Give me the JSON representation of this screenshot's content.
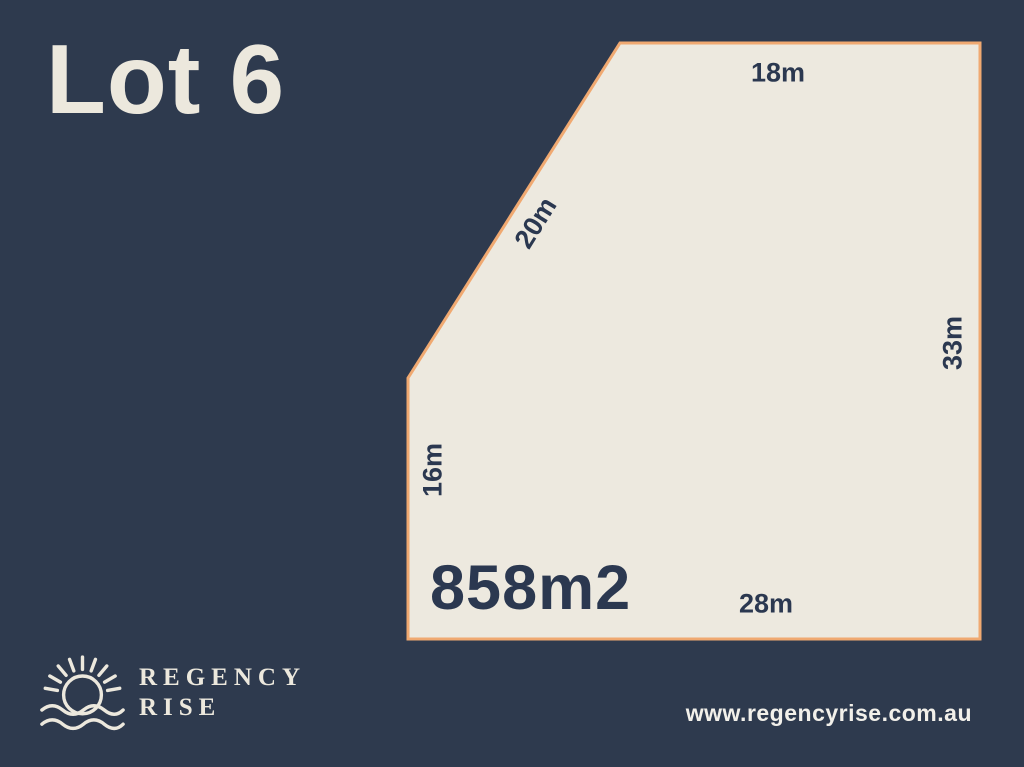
{
  "title": "Lot 6",
  "lot": {
    "area": "858m2",
    "dimensions": {
      "top": "18m",
      "diagonal": "20m",
      "right": "33m",
      "left": "16m",
      "bottom": "28m"
    }
  },
  "branding": {
    "logo_name_line1": "REGENCY",
    "logo_name_line2": "RISE",
    "logo_icon": "rising-sun-over-waves-icon",
    "website": "www.regencyrise.com.au"
  },
  "colors": {
    "background": "#2e3a4e",
    "lot_fill": "#ede9df",
    "lot_border": "#f0a971",
    "text_dark": "#2b3850",
    "text_light": "#ece8dd",
    "website_text": "#f2f0ea"
  }
}
